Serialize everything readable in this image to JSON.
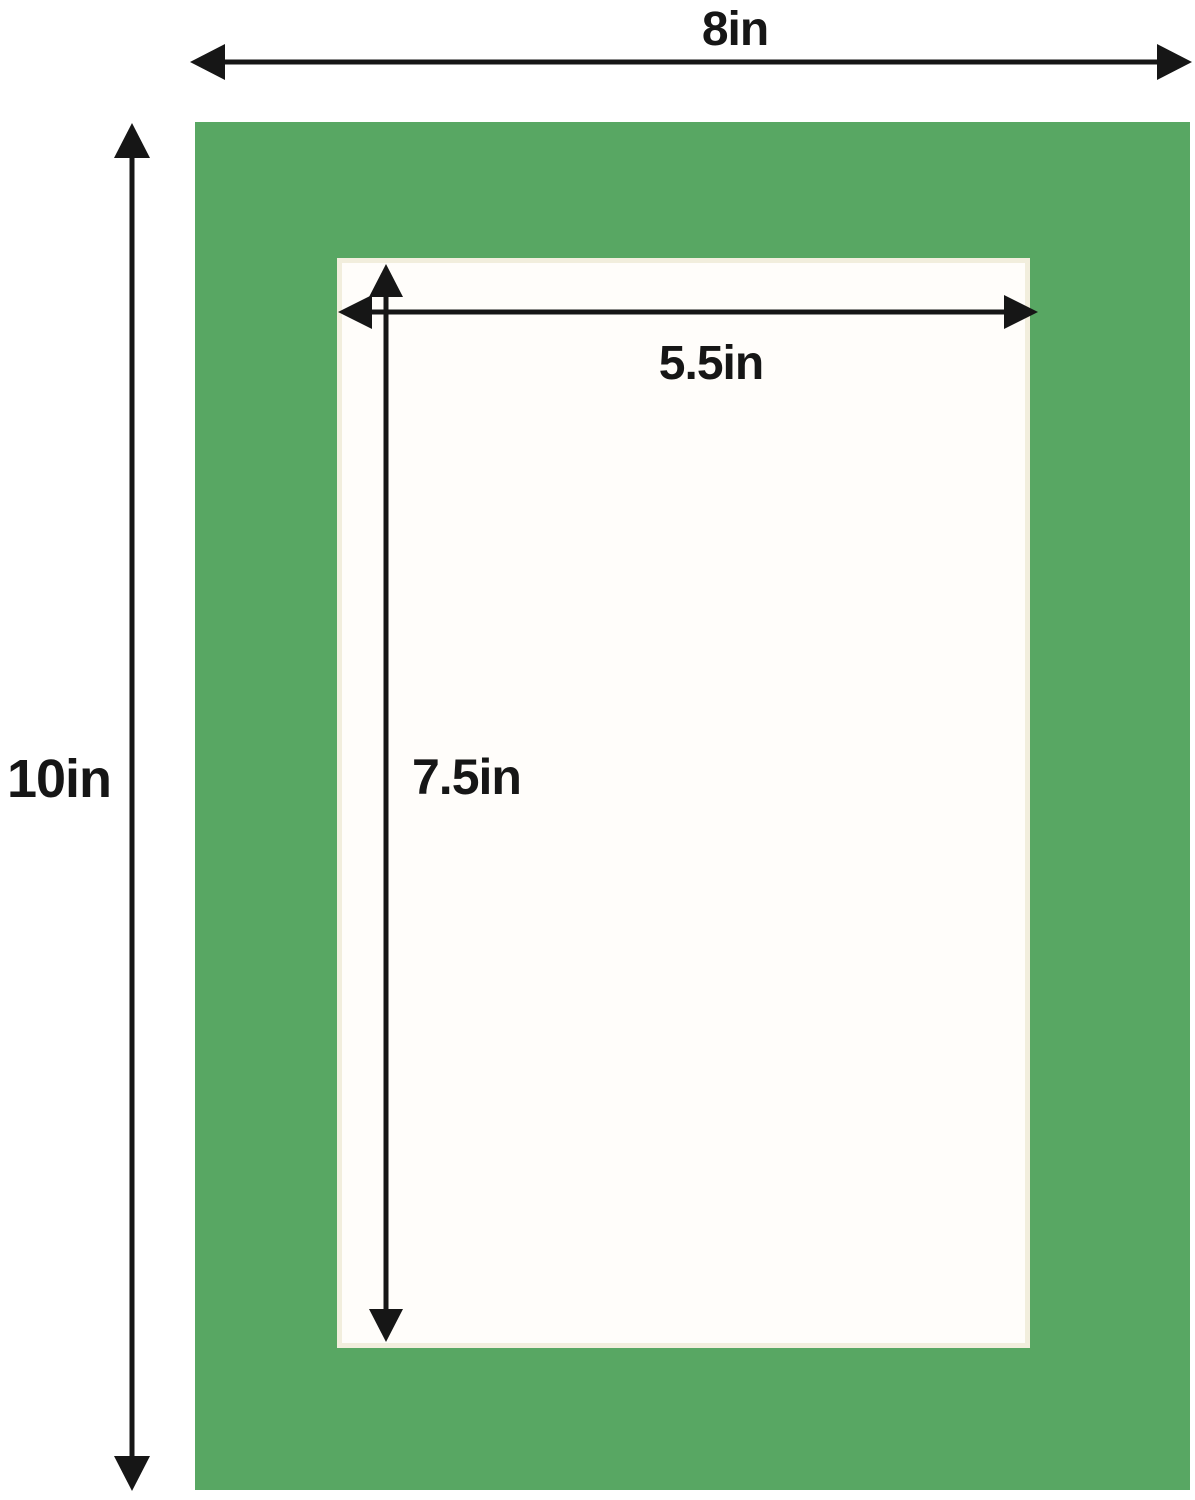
{
  "diagram": {
    "outer_width_label": "8in",
    "outer_height_label": "10in",
    "opening_width_label": "5.5in",
    "opening_height_label": "7.5in",
    "outer_width_in": 8,
    "outer_height_in": 10,
    "opening_width_in": 5.5,
    "opening_height_in": 7.5,
    "colors": {
      "mat_green": "#58a763",
      "arrow_black": "#161616",
      "background": "#ffffff",
      "opening_fill": "#fffdfa",
      "bevel_cream": "#f2eedd"
    }
  }
}
